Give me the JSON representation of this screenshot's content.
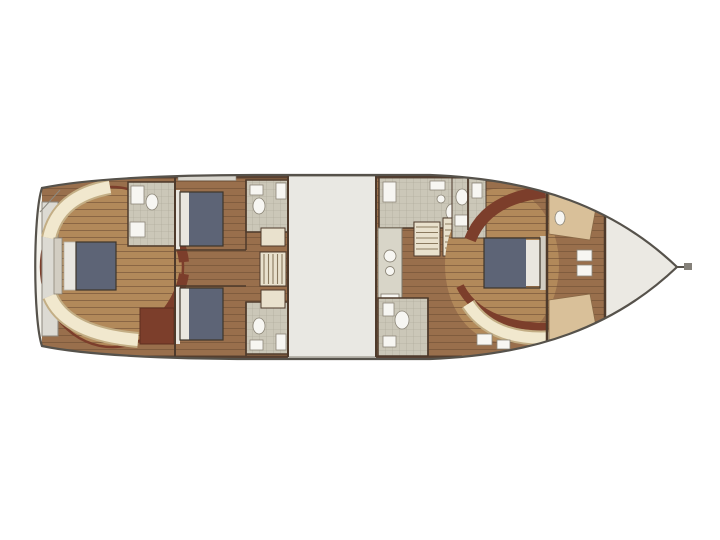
{
  "canvas": {
    "width": 720,
    "height": 540,
    "background": "#ffffff"
  },
  "figure": {
    "type": "yacht-interior-floor-plan",
    "orientation": "bow-right",
    "text_visible": "none"
  },
  "colors": {
    "hull_fill": "#f3f1ea",
    "hull_line": "#56524b",
    "wood_dark": "#996f4c",
    "wood_light": "#b2895a",
    "plank_line": "#7c5a3c",
    "wall": "#4e3a2b",
    "redbrown": "#7c3e2b",
    "cream": "#f1e8ce",
    "cream_edge": "#c3ae85",
    "bed_blue": "#5d6476",
    "bed_linen": "#e9e6df",
    "headboard": "#d2cdc2",
    "tile": "#cbc7b8",
    "tile_line": "#aaa695",
    "fixture": "#f7f6f2",
    "fixture_line": "#8c8678",
    "saloon": "#e9e8e3",
    "saloon_edge": "#a9a59b",
    "foredeck": "#ebe9e3",
    "transom": "#dcdad3",
    "tan_berth": "#d9c099",
    "stairs_fill": "#e9e1cd",
    "stairs_line": "#8a7a5f",
    "counter": "#d8d5c8",
    "window": "#d8d5cd",
    "bow_stub": "#85817a"
  },
  "sections": [
    {
      "id": "transom-platform",
      "label": "Transom platform"
    },
    {
      "id": "aft-master-cabin",
      "label": "Aft master cabin"
    },
    {
      "id": "master-head",
      "label": "Master head"
    },
    {
      "id": "guest-cabin-upper",
      "label": "Guest cabin (upper)"
    },
    {
      "id": "guest-cabin-lower",
      "label": "Guest cabin (lower)"
    },
    {
      "id": "guest-head-upper",
      "label": "Guest head (upper)"
    },
    {
      "id": "guest-head-lower",
      "label": "Guest head (lower)"
    },
    {
      "id": "aft-companionway",
      "label": "Aft companionway stairs"
    },
    {
      "id": "saloon-casing",
      "label": "Saloon / engine casing"
    },
    {
      "id": "galley",
      "label": "Galley"
    },
    {
      "id": "mid-companionway",
      "label": "Amidships companionway stairs"
    },
    {
      "id": "day-head-upper",
      "label": "Day head (upper)"
    },
    {
      "id": "day-head-lower",
      "label": "Day head (lower)"
    },
    {
      "id": "vip-cabin",
      "label": "VIP cabin"
    },
    {
      "id": "vip-head",
      "label": "VIP head"
    },
    {
      "id": "crew-cabin",
      "label": "Crew cabin"
    },
    {
      "id": "foredeck",
      "label": "Foredeck"
    },
    {
      "id": "bowsprit",
      "label": "Bowsprit"
    }
  ]
}
